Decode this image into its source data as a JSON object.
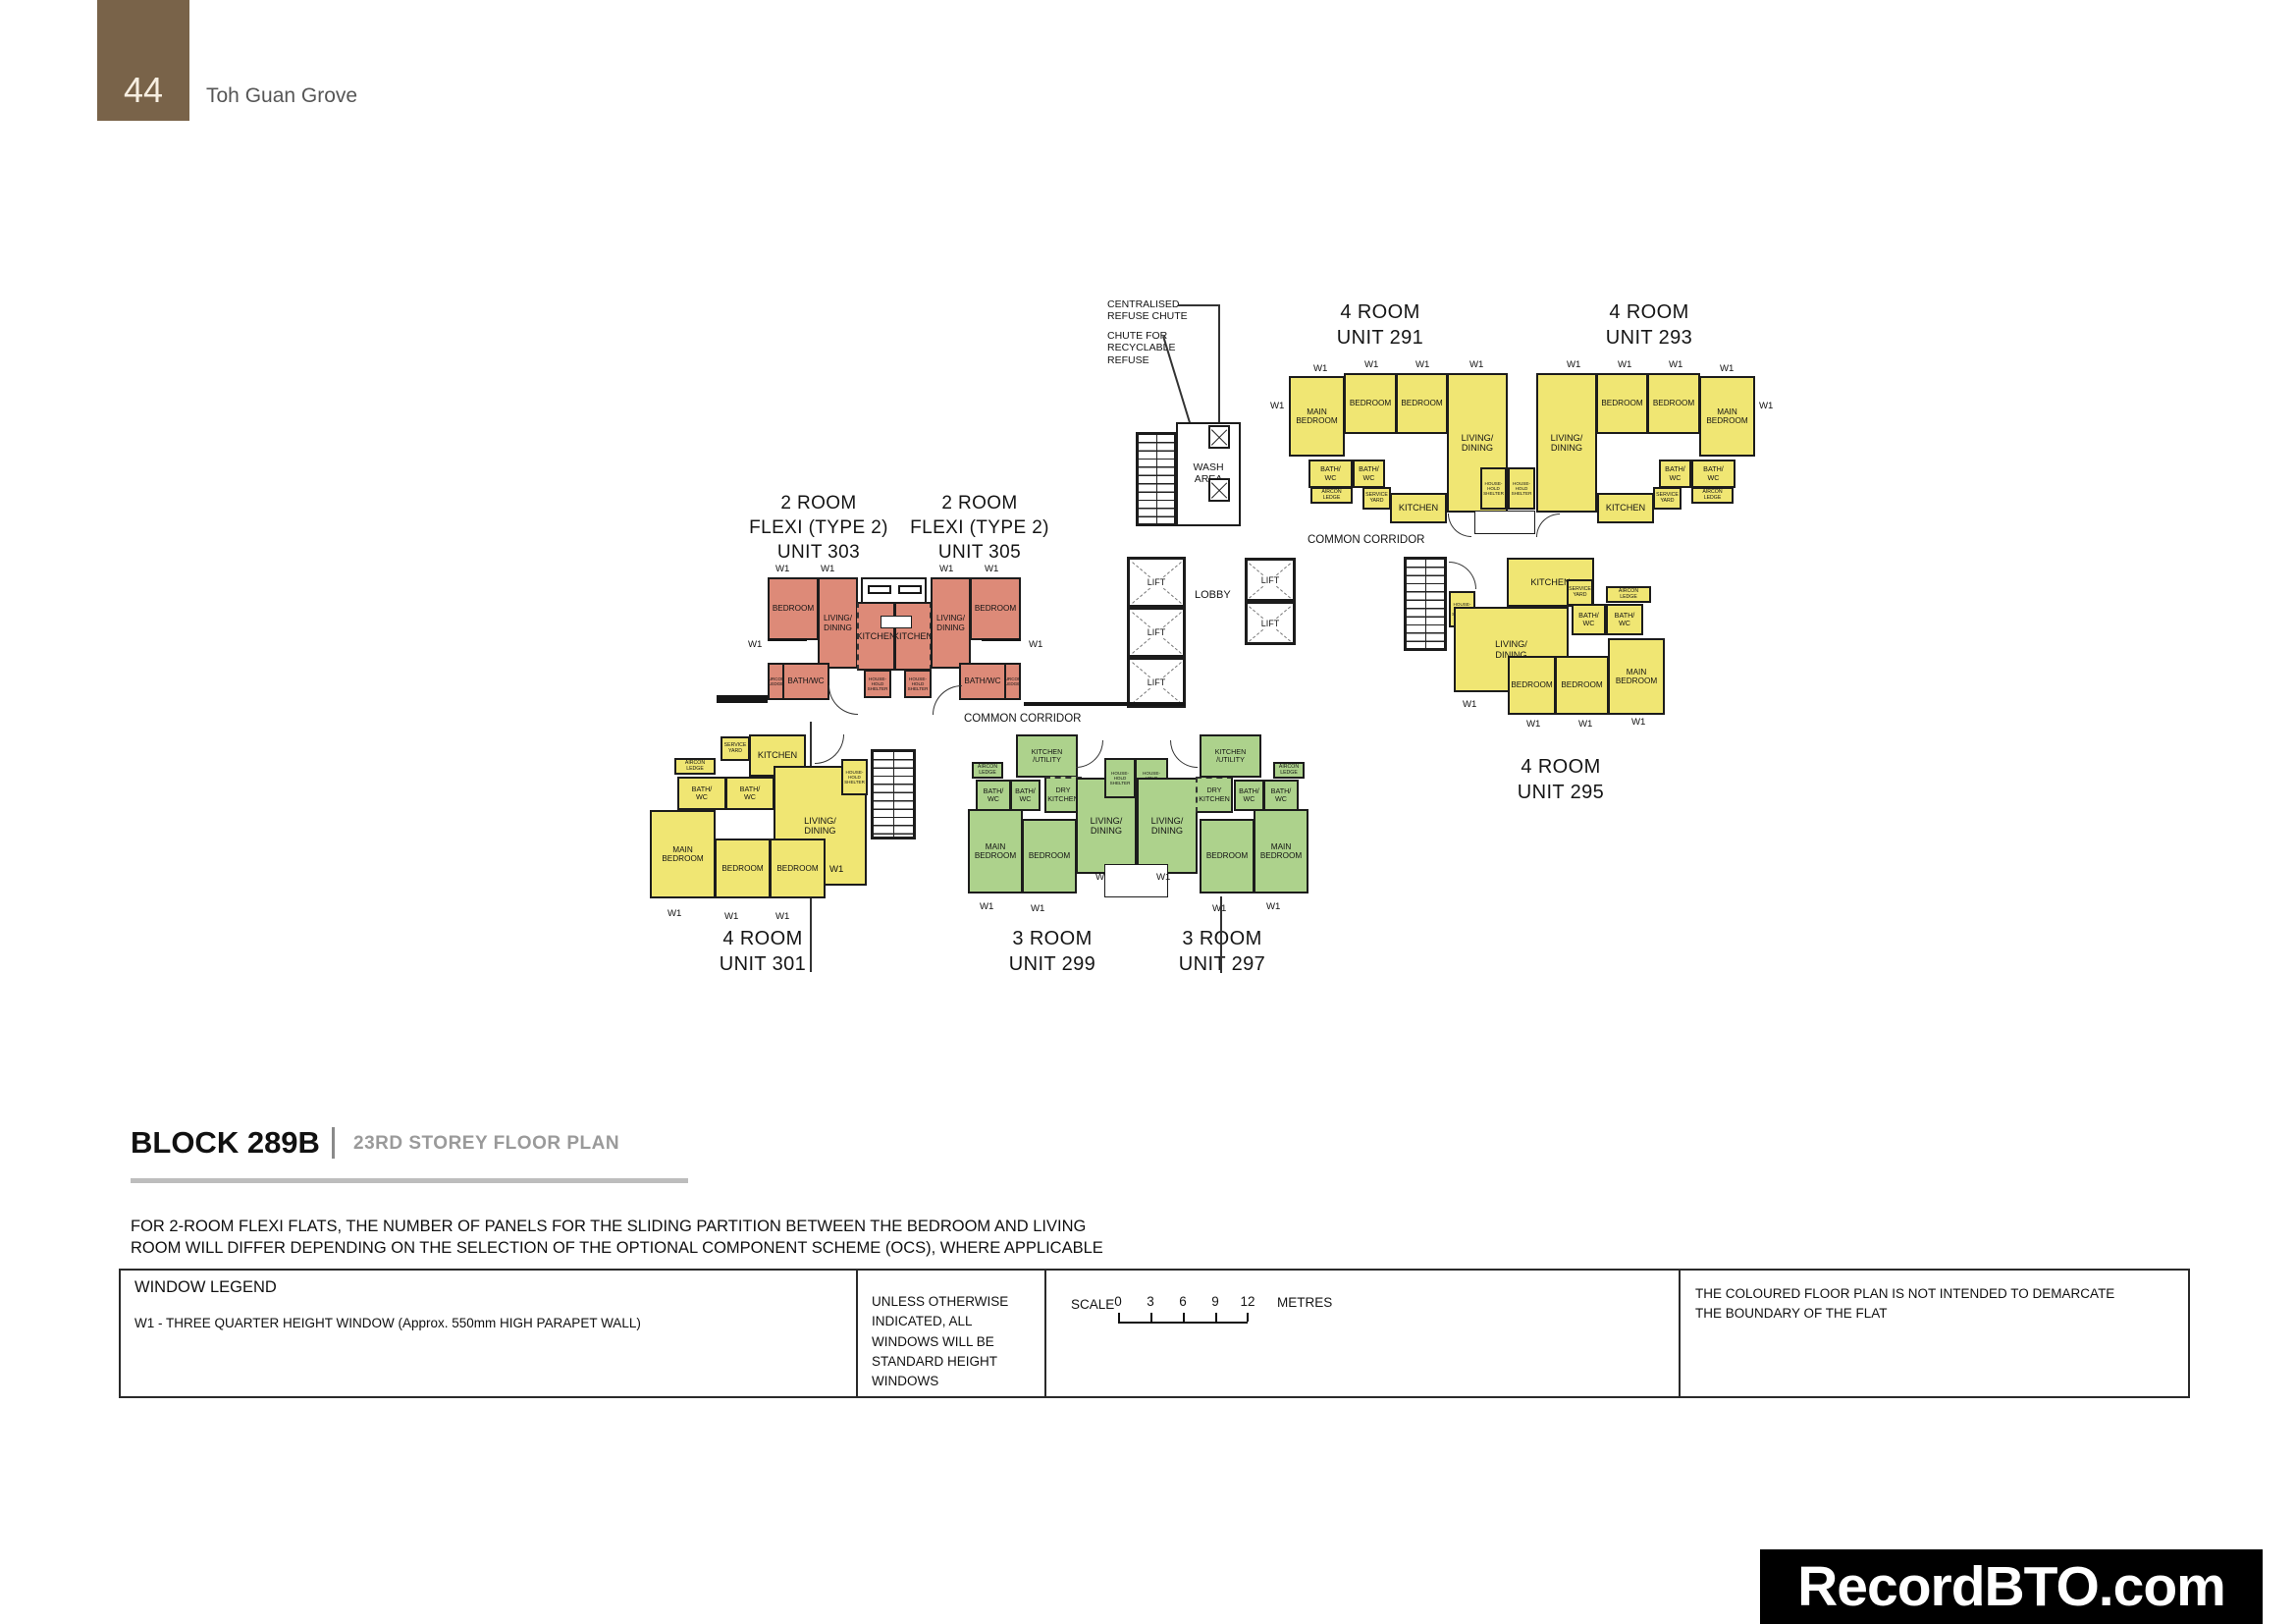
{
  "page": {
    "number": "44",
    "project": "Toh Guan Grove"
  },
  "title_block": {
    "block": "BLOCK 289B",
    "storey": "23RD STOREY FLOOR PLAN"
  },
  "note": {
    "line1": "FOR 2-ROOM FLEXI FLATS, THE NUMBER OF PANELS FOR THE SLIDING PARTITION BETWEEN THE BEDROOM AND LIVING",
    "line2": "ROOM WILL DIFFER DEPENDING ON THE SELECTION OF THE OPTIONAL COMPONENT SCHEME (OCS), WHERE APPLICABLE"
  },
  "legend": {
    "window_legend_title": "WINDOW LEGEND",
    "w1_definition": "W1 - THREE QUARTER HEIGHT WINDOW (Approx. 550mm HIGH PARAPET WALL)",
    "windows_note": "UNLESS OTHERWISE INDICATED, ALL WINDOWS WILL BE STANDARD HEIGHT WINDOWS",
    "scale_label": "SCALE",
    "scale_ticks": [
      "0",
      "3",
      "6",
      "9",
      "12"
    ],
    "scale_unit": "METRES",
    "boundary_note": "THE COLOURED FLOOR PLAN IS NOT INTENDED TO DEMARCATE THE BOUNDARY OF THE FLAT"
  },
  "watermark": "RecordBTO.com",
  "colors": {
    "four_room": "#f0e673",
    "three_room": "#add28c",
    "two_room_flexi": "#dd8a78",
    "header_brown": "#796349",
    "wall": "#1c1c1c"
  },
  "annotations": {
    "centralised_refuse_chute": "CENTRALISED\nREFUSE CHUTE",
    "chute_recyclable": "CHUTE FOR\nRECYCLABLE\nREFUSE",
    "wash_area": "WASH\nAREA",
    "lobby": "LOBBY",
    "lift": "LIFT",
    "common_corridor": "COMMON CORRIDOR",
    "w1": "W1"
  },
  "labels": {
    "main_bedroom": "MAIN\nBEDROOM",
    "bedroom": "BEDROOM",
    "living_dining": "LIVING/\nDINING",
    "kitchen": "KITCHEN",
    "kitchen_utility": "KITCHEN\n/UTILITY",
    "dry_kitchen": "DRY\nKITCHEN",
    "bath_wc": "BATH/\nWC",
    "bath_wc_inline": "BATH/WC",
    "household_shelter": "HOUSE-\nHOLD\nSHELTER",
    "service_yard": "SERVICE\nYARD",
    "aircon_ledge": "AIRCON\nLEDGE"
  },
  "units": [
    {
      "id": "291",
      "type": "4 ROOM",
      "unit": "UNIT 291",
      "color_key": "four_room",
      "rooms": [
        "MAIN BEDROOM",
        "BEDROOM",
        "BEDROOM",
        "LIVING/DINING",
        "BATH/WC",
        "BATH/WC",
        "KITCHEN",
        "SERVICE YARD",
        "AIRCON LEDGE",
        "HOUSEHOLD SHELTER"
      ]
    },
    {
      "id": "293",
      "type": "4 ROOM",
      "unit": "UNIT 293",
      "color_key": "four_room",
      "rooms": [
        "MAIN BEDROOM",
        "BEDROOM",
        "BEDROOM",
        "LIVING/DINING",
        "BATH/WC",
        "BATH/WC",
        "KITCHEN",
        "SERVICE YARD",
        "AIRCON LEDGE",
        "HOUSEHOLD SHELTER"
      ]
    },
    {
      "id": "295",
      "type": "4 ROOM",
      "unit": "UNIT 295",
      "color_key": "four_room",
      "rooms": [
        "MAIN BEDROOM",
        "BEDROOM",
        "BEDROOM",
        "LIVING/DINING",
        "BATH/WC",
        "BATH/WC",
        "KITCHEN",
        "SERVICE YARD",
        "AIRCON LEDGE",
        "HOUSEHOLD SHELTER"
      ]
    },
    {
      "id": "301",
      "type": "4 ROOM",
      "unit": "UNIT 301",
      "color_key": "four_room",
      "rooms": [
        "MAIN BEDROOM",
        "BEDROOM",
        "BEDROOM",
        "LIVING/DINING",
        "BATH/WC",
        "BATH/WC",
        "KITCHEN",
        "SERVICE YARD",
        "AIRCON LEDGE",
        "HOUSEHOLD SHELTER"
      ]
    },
    {
      "id": "299",
      "type": "3 ROOM",
      "unit": "UNIT 299",
      "color_key": "three_room",
      "rooms": [
        "MAIN BEDROOM",
        "BEDROOM",
        "LIVING/DINING",
        "DRY KITCHEN",
        "KITCHEN/UTILITY",
        "BATH/WC",
        "BATH/WC",
        "AIRCON LEDGE",
        "HOUSEHOLD SHELTER"
      ]
    },
    {
      "id": "297",
      "type": "3 ROOM",
      "unit": "UNIT 297",
      "color_key": "three_room",
      "rooms": [
        "MAIN BEDROOM",
        "BEDROOM",
        "LIVING/DINING",
        "DRY KITCHEN",
        "KITCHEN/UTILITY",
        "BATH/WC",
        "BATH/WC",
        "AIRCON LEDGE",
        "HOUSEHOLD SHELTER"
      ]
    },
    {
      "id": "303",
      "type": "2 ROOM",
      "flexi": "FLEXI (TYPE 2)",
      "unit": "UNIT 303",
      "color_key": "two_room_flexi",
      "rooms": [
        "BEDROOM",
        "LIVING/DINING",
        "KITCHEN",
        "BATH/WC",
        "AIRCON LEDGE",
        "HOUSEHOLD SHELTER"
      ]
    },
    {
      "id": "305",
      "type": "2 ROOM",
      "flexi": "FLEXI (TYPE 2)",
      "unit": "UNIT 305",
      "color_key": "two_room_flexi",
      "rooms": [
        "BEDROOM",
        "LIVING/DINING",
        "KITCHEN",
        "BATH/WC",
        "AIRCON LEDGE",
        "HOUSEHOLD SHELTER"
      ]
    }
  ]
}
